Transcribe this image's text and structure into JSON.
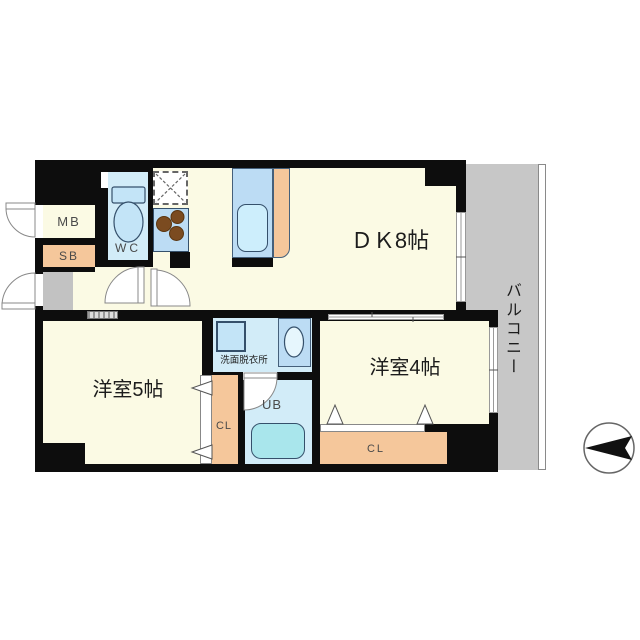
{
  "plan": {
    "type": "japanese-apartment-floor-plan",
    "rooms": {
      "dk": {
        "label": "ＤＫ8帖"
      },
      "western_5": {
        "label": "洋室5帖"
      },
      "western_4": {
        "label": "洋室4帖"
      },
      "balcony": {
        "label": "バルコニー"
      },
      "wc": {
        "label": "WC"
      },
      "meter_box": {
        "label": "MB"
      },
      "shoe_box": {
        "label": "SB"
      },
      "washroom": {
        "label": "洗面脱衣所"
      },
      "unit_bath": {
        "label": "UB"
      },
      "closet_west5": {
        "label": "CL"
      },
      "closet_west4": {
        "label": "CL"
      }
    },
    "colors": {
      "wall": "#0d0d0d",
      "room_floor": "#fbfae4",
      "wet_area_floor": "#d2ecf8",
      "closet_counter": "#f5c79b",
      "balcony_floor": "#c7c7c7",
      "entrance_floor": "#c2c2c2",
      "fixture_blue": "#bcdcf4",
      "sink_blue": "#cdeefc",
      "bathtub": "#a9e6ec",
      "stove_burners": "#7b4b20"
    },
    "compass": {
      "direction": "north-left"
    }
  }
}
